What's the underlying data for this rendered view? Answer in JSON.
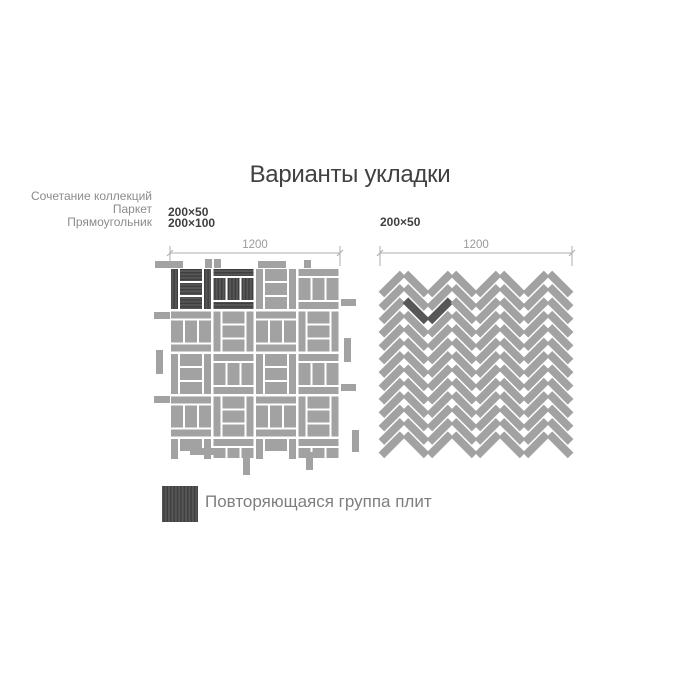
{
  "title": "Варианты укладки",
  "note": {
    "lines": [
      "Сочетание коллекций",
      "Паркет",
      "Прямоугольник"
    ]
  },
  "left_diagram": {
    "sizes": [
      "200×50",
      "200×100"
    ],
    "dimension_label": "1200",
    "pattern": "parquet-basketweave"
  },
  "right_diagram": {
    "sizes": [
      "200×50"
    ],
    "dimension_label": "1200",
    "pattern": "herringbone"
  },
  "legend": {
    "label": "Повторяющаяся группа плит"
  },
  "colors": {
    "background": "#ffffff",
    "tile": "#a2a2a2",
    "highlight_base": "#575757",
    "highlight_stripe": "#3f3f3f",
    "dimension": "#adadad",
    "dimension_text": "#9a9a9a",
    "muted_text": "#8b8b8b",
    "dark_text": "#3f3f3f"
  }
}
